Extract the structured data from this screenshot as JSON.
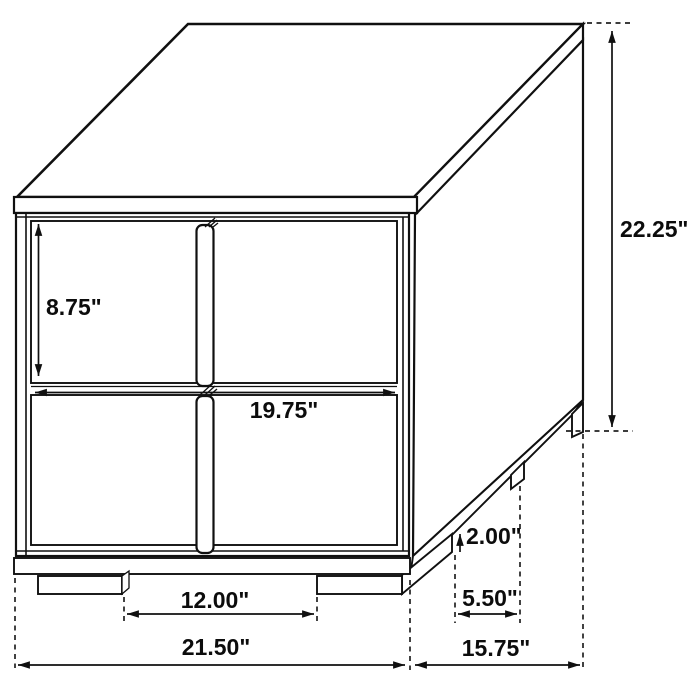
{
  "diagram": {
    "background": "#ffffff",
    "line_color": "#101010",
    "labels": {
      "drawer_height": "8.75\"",
      "overall_height": "22.25\"",
      "drawer_width": "19.75\"",
      "front_leg_spacing": "12.00\"",
      "overall_width": "21.50\"",
      "overall_depth": "15.75\"",
      "side_leg_spacing": "5.50\"",
      "leg_height": "2.00\""
    }
  }
}
